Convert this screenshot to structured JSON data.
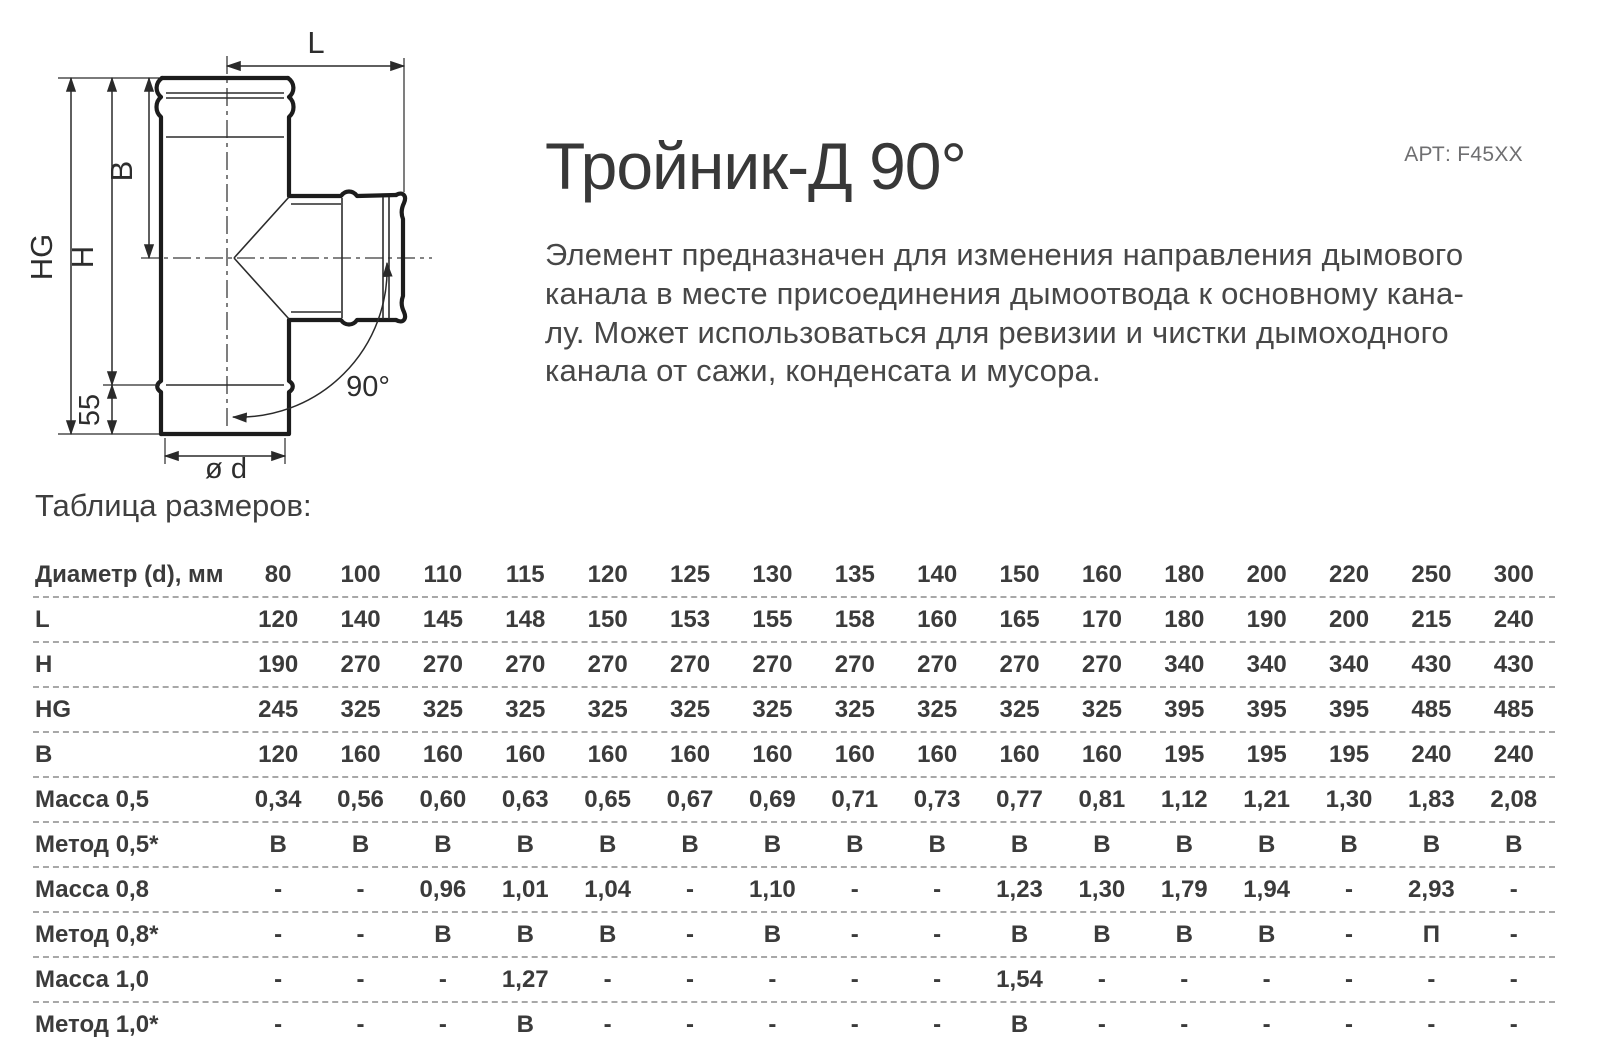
{
  "header": {
    "title": "Тройник-Д 90°",
    "article": "АРТ: F45XX",
    "description_lines": [
      "Элемент предназначен для изменения направления дымового",
      "канала в месте присоединения дымоотвода к основному кана-",
      "лу. Может использоваться для ревизии и чистки дымоходного",
      "канала от сажи, конденсата и мусора."
    ]
  },
  "drawing": {
    "labels": {
      "l": "L",
      "b": "B",
      "h": "H",
      "hg": "HG",
      "offset55": "55",
      "diameter": "ø d",
      "angle": "90°"
    }
  },
  "table": {
    "caption": "Таблица размеров:",
    "header_label": "Диаметр (d), мм",
    "columns": [
      "80",
      "100",
      "110",
      "115",
      "120",
      "125",
      "130",
      "135",
      "140",
      "150",
      "160",
      "180",
      "200",
      "220",
      "250",
      "300"
    ],
    "rows": [
      {
        "label": "L",
        "values": [
          "120",
          "140",
          "145",
          "148",
          "150",
          "153",
          "155",
          "158",
          "160",
          "165",
          "170",
          "180",
          "190",
          "200",
          "215",
          "240"
        ]
      },
      {
        "label": "H",
        "values": [
          "190",
          "270",
          "270",
          "270",
          "270",
          "270",
          "270",
          "270",
          "270",
          "270",
          "270",
          "340",
          "340",
          "340",
          "430",
          "430"
        ]
      },
      {
        "label": "HG",
        "values": [
          "245",
          "325",
          "325",
          "325",
          "325",
          "325",
          "325",
          "325",
          "325",
          "325",
          "325",
          "395",
          "395",
          "395",
          "485",
          "485"
        ]
      },
      {
        "label": "B",
        "values": [
          "120",
          "160",
          "160",
          "160",
          "160",
          "160",
          "160",
          "160",
          "160",
          "160",
          "160",
          "195",
          "195",
          "195",
          "240",
          "240"
        ]
      },
      {
        "label": "Масса 0,5",
        "values": [
          "0,34",
          "0,56",
          "0,60",
          "0,63",
          "0,65",
          "0,67",
          "0,69",
          "0,71",
          "0,73",
          "0,77",
          "0,81",
          "1,12",
          "1,21",
          "1,30",
          "1,83",
          "2,08"
        ]
      },
      {
        "label": "Метод 0,5*",
        "values": [
          "В",
          "В",
          "В",
          "В",
          "В",
          "В",
          "В",
          "В",
          "В",
          "В",
          "В",
          "В",
          "В",
          "В",
          "В",
          "В"
        ]
      },
      {
        "label": "Масса 0,8",
        "values": [
          "-",
          "-",
          "0,96",
          "1,01",
          "1,04",
          "-",
          "1,10",
          "-",
          "-",
          "1,23",
          "1,30",
          "1,79",
          "1,94",
          "-",
          "2,93",
          "-"
        ]
      },
      {
        "label": "Метод 0,8*",
        "values": [
          "-",
          "-",
          "В",
          "В",
          "В",
          "-",
          "В",
          "-",
          "-",
          "В",
          "В",
          "В",
          "В",
          "-",
          "П",
          "-"
        ]
      },
      {
        "label": "Масса 1,0",
        "values": [
          "-",
          "-",
          "-",
          "1,27",
          "-",
          "-",
          "-",
          "-",
          "-",
          "1,54",
          "-",
          "-",
          "-",
          "-",
          "-",
          "-"
        ]
      },
      {
        "label": "Метод 1,0*",
        "values": [
          "-",
          "-",
          "-",
          "В",
          "-",
          "-",
          "-",
          "-",
          "-",
          "В",
          "-",
          "-",
          "-",
          "-",
          "-",
          "-"
        ]
      }
    ]
  }
}
